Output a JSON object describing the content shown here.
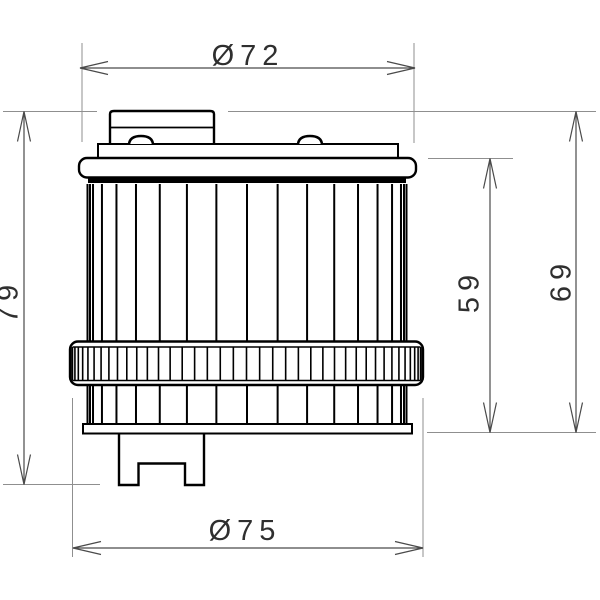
{
  "drawing": {
    "dimensions": {
      "top_diameter": "Ø72",
      "bottom_diameter": "Ø75",
      "overall_height": "79",
      "element_height": "59",
      "body_height": "69"
    },
    "colors": {
      "outline": "#000000",
      "dimension_line": "#4a4a4a",
      "reference_line": "#8f8f8f",
      "text": "#2f2f2f",
      "background": "#ffffff"
    }
  }
}
